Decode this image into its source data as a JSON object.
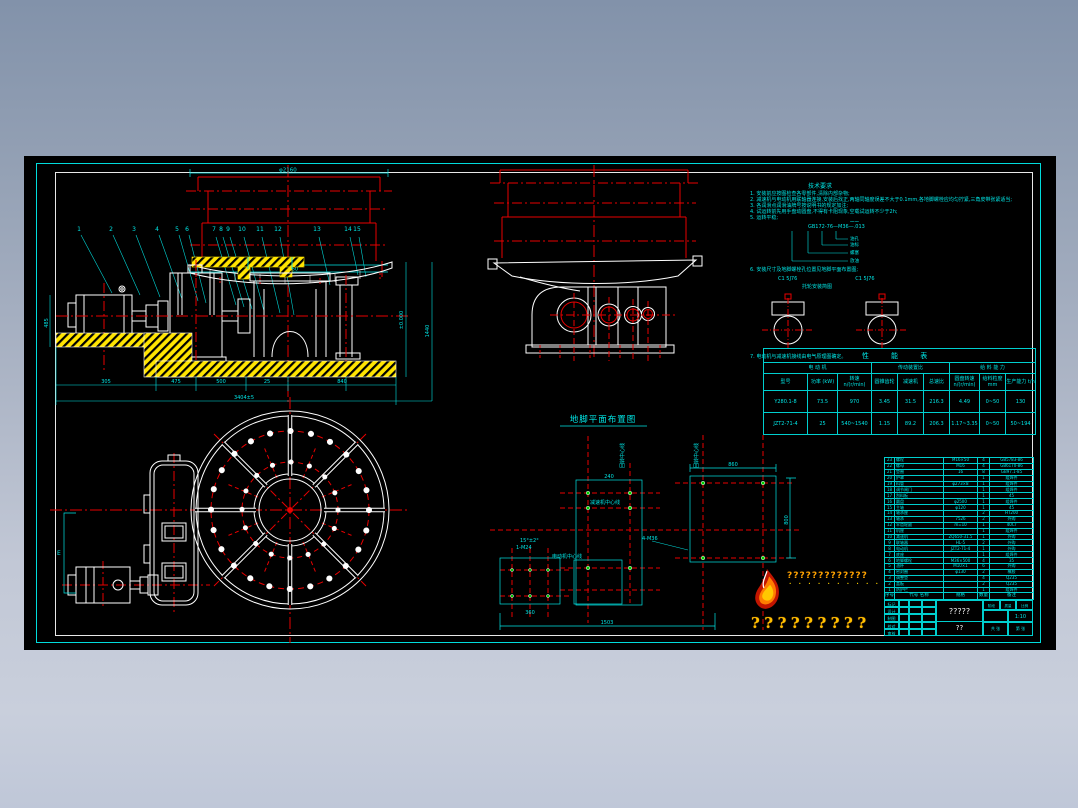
{
  "window": {
    "background_top": "#8292aa",
    "background_bottom": "#c9cfdc",
    "canvas_color": "#000000"
  },
  "colors": {
    "line_cyan": "#00e5e5",
    "line_red": "#e80000",
    "line_white": "#ffffff",
    "hatch_yellow": "#ffe400",
    "bolt_green": "#00d000",
    "logo_orange": "#ff7d00",
    "logo_gold": "#ffc000"
  },
  "view1": {
    "dim_top": "φ2160",
    "dim_mid1": "φ1975",
    "dim_mid2": "φ1960",
    "leaders": [
      {
        "n": "1",
        "x": 39
      },
      {
        "n": "2",
        "x": 71
      },
      {
        "n": "3",
        "x": 94
      },
      {
        "n": "4",
        "x": 117
      },
      {
        "n": "5",
        "x": 137
      },
      {
        "n": "6",
        "x": 147
      },
      {
        "n": "7",
        "x": 174
      },
      {
        "n": "8",
        "x": 181
      },
      {
        "n": "9",
        "x": 188
      },
      {
        "n": "10",
        "x": 202
      },
      {
        "n": "11",
        "x": 220
      },
      {
        "n": "12",
        "x": 238
      },
      {
        "n": "13",
        "x": 277
      },
      {
        "n": "14",
        "x": 308
      },
      {
        "n": "15",
        "x": 317
      }
    ],
    "dims_bottom": [
      "305",
      "475",
      "500",
      "25",
      "840"
    ],
    "dim_overall": "3404±5",
    "dim_left": "485",
    "dim_right1": "±0.000",
    "dim_right2": "1440"
  },
  "notes": {
    "heading": "技术要求",
    "lines": [
      "1. 安装前应按图检查各零部件,清除内部杂物;",
      "2. 减速机与电动机用联轴器连接,安装后找正,两轴同轴度误差不大于0.1mm,各地脚螺栓应均匀拧紧,三角皮带张紧适当;",
      "3. 各润滑点润滑油牌号按说明书的规定加注;",
      "4. 试运转前先用手盘动圆盘,不得有卡阻现象,空载试运转不少于2h;",
      "5. 运转平稳;"
    ],
    "thread_spec": "GB172-76—M36—.013",
    "thread_labels": [
      "油孔",
      "油标",
      "螺塞",
      "放油"
    ],
    "line6": "6. 安装尺寸及地脚螺栓孔位置见地脚平面布置图;",
    "roller_labels": [
      "C1 5J76",
      "C1 5J76"
    ],
    "roller_title": "托轮安装简图",
    "line7": "7. 电动机与减速机接线由电气原理图确定。"
  },
  "perf_table": {
    "title": "性 能 表",
    "groups": [
      "电  动  机",
      "传动装置比",
      "给 料 能 力"
    ],
    "headers": [
      "型号",
      "功率 (kW)",
      "转速 n/(r/min)",
      "圆锥齿轮",
      "减速机",
      "总速比",
      "圆盘转速 n/(r/min)",
      "给料粒度 mm",
      "生产能力 t/h"
    ],
    "rows": [
      [
        "Y280.1-8",
        "73.5",
        "970",
        "3.45",
        "31.5",
        "216.3",
        "4.49",
        "0~50",
        "130"
      ],
      [
        "JZT2-71-4",
        "25",
        "540~1540",
        "1.15",
        "89.2",
        "206.3",
        "1.17~3.35",
        "0~50",
        "50~194"
      ]
    ]
  },
  "bolt_plan": {
    "title": "地脚平面布置图",
    "label_v1": "回转中心线",
    "label_v2": "回转中心线",
    "label_h1": "减速机中心线",
    "label_h2": "电动机中心线",
    "bolt_note1": "4-M36",
    "bolt_note2": "1-M24",
    "dims": {
      "top": "860",
      "left_w": "240",
      "right_h": "800",
      "bottom": "1503",
      "small": "360",
      "angle": "15°±2°"
    }
  },
  "plan_view": {
    "bracket_label": "E"
  },
  "bom": {
    "header": {
      "no": "序号",
      "name": "代号 名称",
      "spec": "规格",
      "qty": "数量",
      "rem": "备注"
    },
    "rows": [
      {
        "no": "23",
        "name": "螺栓",
        "spec": "M16×50",
        "qty": "4",
        "rem": "GB5783-86"
      },
      {
        "no": "22",
        "name": "螺母",
        "spec": "M16",
        "qty": "4",
        "rem": "GB6170-86"
      },
      {
        "no": "21",
        "name": "垫圈",
        "spec": "16",
        "qty": "8",
        "rem": "GB97.1-85"
      },
      {
        "no": "20",
        "name": "护罩",
        "spec": "",
        "qty": "1",
        "rem": "组焊件"
      },
      {
        "no": "19",
        "name": "料管",
        "spec": "φ273×8",
        "qty": "1",
        "rem": "组焊件"
      },
      {
        "no": "18",
        "name": "调节闸门",
        "spec": "",
        "qty": "1",
        "rem": "组焊件"
      },
      {
        "no": "17",
        "name": "刮料板",
        "spec": "",
        "qty": "1",
        "rem": "45"
      },
      {
        "no": "16",
        "name": "圆盘",
        "spec": "φ2500",
        "qty": "1",
        "rem": "组焊件"
      },
      {
        "no": "15",
        "name": "主轴",
        "spec": "φ120",
        "qty": "1",
        "rem": "45"
      },
      {
        "no": "14",
        "name": "轴承座",
        "spec": "",
        "qty": "2",
        "rem": "HT200"
      },
      {
        "no": "13",
        "name": "轴承",
        "spec": "7526",
        "qty": "2",
        "rem": "外购"
      },
      {
        "no": "12",
        "name": "伞齿轮副",
        "spec": "m=10",
        "qty": "1",
        "rem": "40Cr"
      },
      {
        "no": "11",
        "name": "机座",
        "spec": "",
        "qty": "1",
        "rem": "组焊件"
      },
      {
        "no": "10",
        "name": "减速机",
        "spec": "ZQ650-31.5",
        "qty": "1",
        "rem": "外购"
      },
      {
        "no": "9",
        "name": "联轴器",
        "spec": "HL-5",
        "qty": "2",
        "rem": "外购"
      },
      {
        "no": "8",
        "name": "电动机",
        "spec": "JZT2-71-4",
        "qty": "1",
        "rem": "外购"
      },
      {
        "no": "7",
        "name": "底座",
        "spec": "",
        "qty": "1",
        "rem": "组焊件"
      },
      {
        "no": "6",
        "name": "地脚螺栓",
        "spec": "M36×500",
        "qty": "4",
        "rem": "35"
      },
      {
        "no": "5",
        "name": "油杯",
        "spec": "M10×1",
        "qty": "6",
        "rem": "外购"
      },
      {
        "no": "4",
        "name": "密封圈",
        "spec": "φ130",
        "qty": "2",
        "rem": "橡胶"
      },
      {
        "no": "3",
        "name": "调整垫",
        "spec": "",
        "qty": "4",
        "rem": "Q235"
      },
      {
        "no": "2",
        "name": "盖板",
        "spec": "",
        "qty": "2",
        "rem": "Q235"
      },
      {
        "no": "1",
        "name": "防护栏",
        "spec": "",
        "qty": "1",
        "rem": "组焊件"
      }
    ]
  },
  "title_block": {
    "left_rows": [
      "标记",
      "设计",
      "制图",
      "校对",
      "审核"
    ],
    "name": "?????",
    "sub": "??",
    "r1": [
      "阶段",
      "质量",
      "比例"
    ],
    "scale": "1:10",
    "r3": [
      "共 张",
      "第 张"
    ]
  },
  "logo": {
    "small_q": "?????????????",
    "dots": "• • • • • • • • • •",
    "big_q": "?????????"
  }
}
